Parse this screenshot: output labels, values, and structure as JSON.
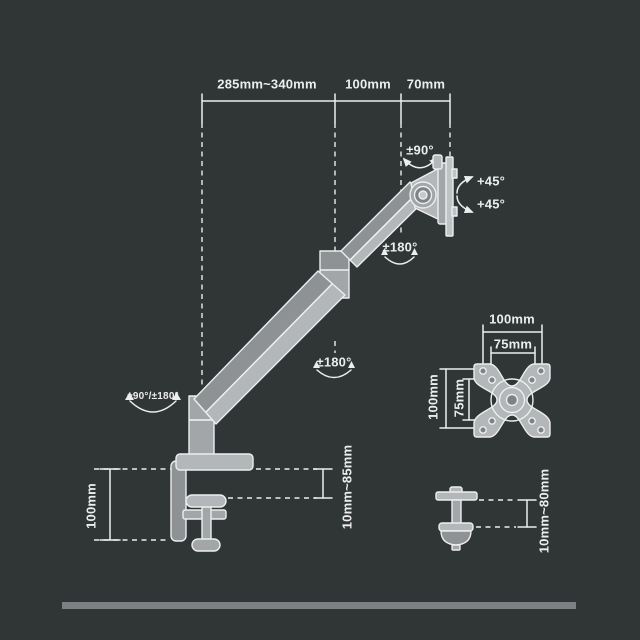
{
  "colors": {
    "bg": "#303536",
    "line": "#eceeee",
    "metal-light": "#b4b7b9",
    "metal-mid": "#a2a6a8",
    "metal-dark": "#8e9294",
    "ground-bar": "#7d8183"
  },
  "top_dimensions": [
    {
      "name": "arm-reach",
      "label": "285mm~340mm"
    },
    {
      "name": "forearm-length",
      "label": "100mm"
    },
    {
      "name": "head-depth",
      "label": "70mm"
    }
  ],
  "rotation_labels": {
    "monitor_tilt": "±90°",
    "vesa_rotate_cw": "+45°",
    "vesa_rotate_ccw": "+45°",
    "head_swivel": "±180°",
    "elbow_swivel": "±180°",
    "base_swivel": "±90°/±180°"
  },
  "clamp_detail": {
    "clamp_height": "100mm",
    "desk_thickness_range": "10mm~85mm"
  },
  "vesa_detail": {
    "outer_width": "100mm",
    "inner_width": "75mm",
    "outer_height": "100mm",
    "inner_height": "75mm"
  },
  "grommet_detail": {
    "desk_thickness_range": "10mm~80mm"
  }
}
